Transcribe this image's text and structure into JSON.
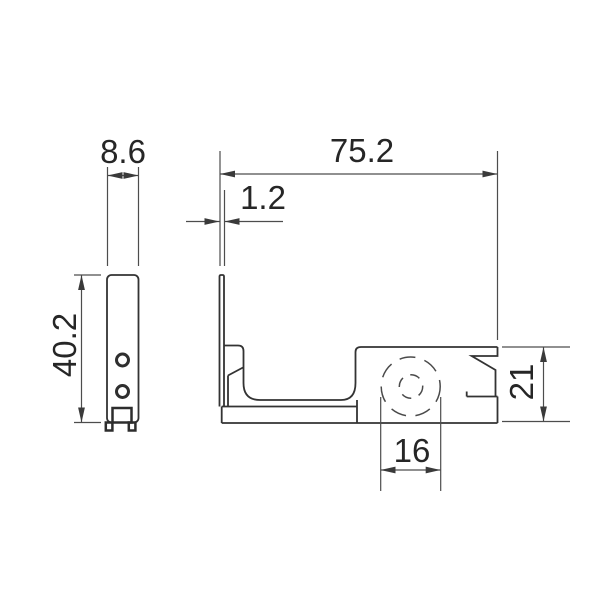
{
  "drawing": {
    "title": "bracket-dimension-drawing",
    "dimensions": {
      "side_width": "8.6",
      "overall_width": "75.2",
      "wall_thickness": "1.2",
      "side_height": "40.2",
      "right_block_height": "21",
      "hidden_hole_diameter": "16"
    },
    "colors": {
      "background": "#ffffff",
      "part_line": "#333333",
      "dimension_line": "#4d4d4d",
      "text": "#262626"
    }
  }
}
